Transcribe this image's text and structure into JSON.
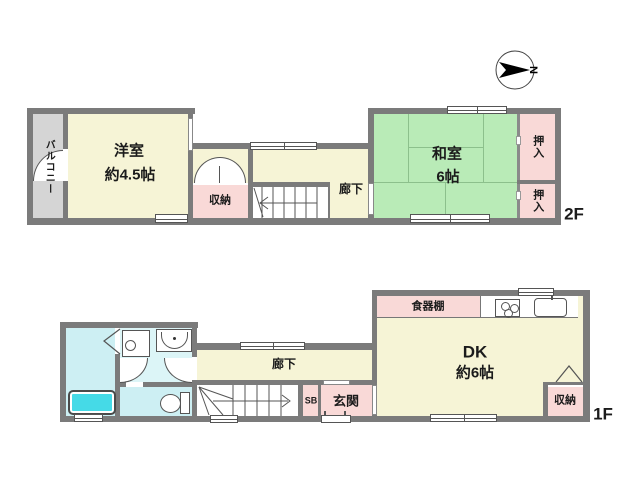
{
  "compass": {
    "north_label": "N"
  },
  "floors": {
    "f2": {
      "label": "2F",
      "balcony": "バルコニー",
      "western_room": {
        "name": "洋室",
        "size": "約4.5帖"
      },
      "storage": "収納",
      "hallway": "廊下",
      "japanese_room": {
        "name": "和室",
        "size": "6帖"
      },
      "closet_upper": "押入",
      "closet_lower": "押入"
    },
    "f1": {
      "label": "1F",
      "hallway": "廊下",
      "shoe_box": "SB",
      "entrance": "玄関",
      "dining_kitchen": {
        "name": "DK",
        "size": "約6帖"
      },
      "cupboard": "食器棚",
      "storage": "収納"
    }
  },
  "colors": {
    "wall": "#7b7b7b",
    "room_yellow": "#f6f4d6",
    "tatami_green": "#b9ebb7",
    "closet_pink": "#f9d9d7",
    "balcony_gray": "#d5d5d5",
    "bath_cyan": "#cdeff3",
    "washroom_cyan": "#dcf5f7",
    "bathtub_cyan": "#45dae7",
    "line": "#555555"
  }
}
